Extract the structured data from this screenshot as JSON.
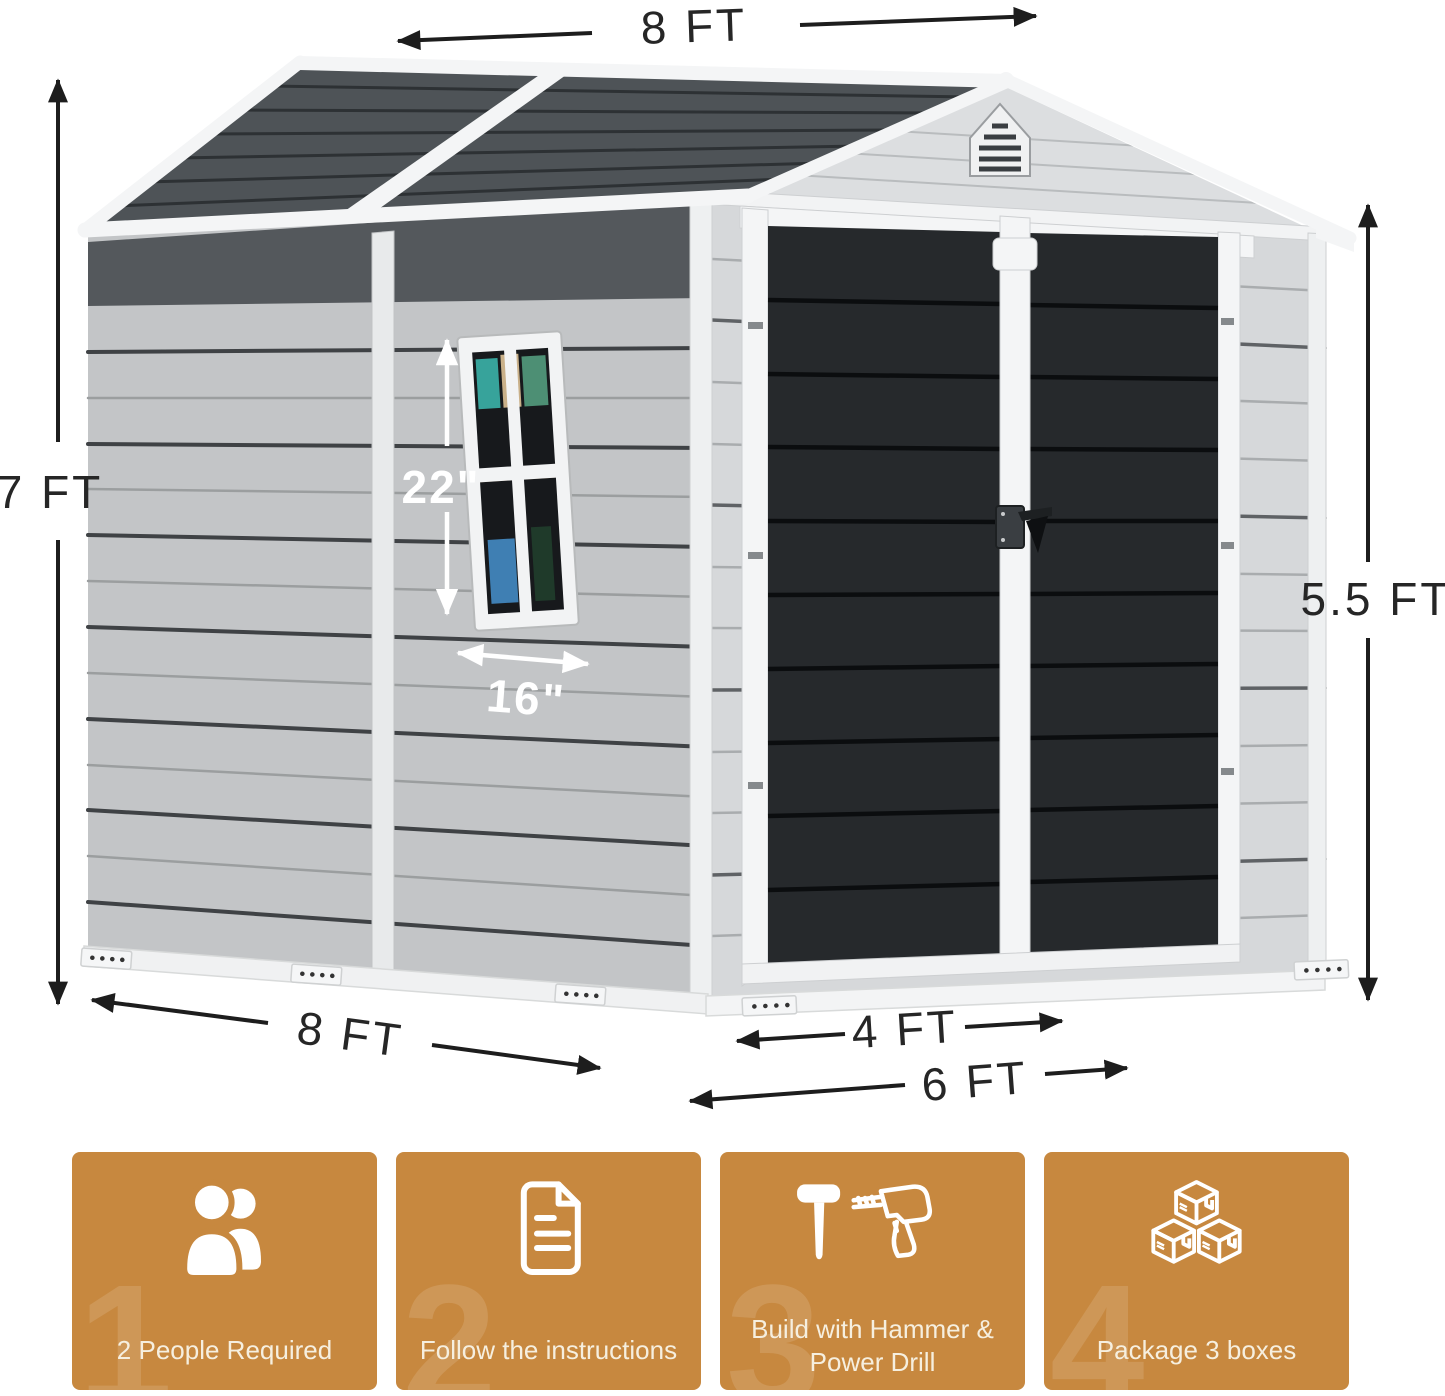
{
  "dims": {
    "roof_length": "8 FT",
    "wall_height": "7 FT",
    "door_height": "5.5 FT",
    "base_depth": "8 FT",
    "door_width": "4 FT",
    "front_width": "6 FT",
    "window_height": "22\"",
    "window_width": "16\""
  },
  "features": [
    {
      "icon": "people-icon",
      "watermark": "1",
      "lines": [
        "2 People Required"
      ]
    },
    {
      "icon": "document-icon",
      "watermark": "2",
      "lines": [
        "Follow the instructions"
      ]
    },
    {
      "icon": "hammer-drill-icon",
      "watermark": "3",
      "lines": [
        "Build with Hammer &",
        "Power Drill"
      ]
    },
    {
      "icon": "boxes-icon",
      "watermark": "4",
      "lines": [
        "Package 3 boxes"
      ]
    }
  ],
  "colors": {
    "accent_orange": "#C7883F",
    "feature_text": "#F6EFDF",
    "roof_dark": "#4E5357",
    "door_dark": "#26292C",
    "siding_side": "#C3C5C7",
    "siding_front": "#D6D8DA",
    "gable": "#DCDEE0",
    "trim_white": "#F4F5F6",
    "dimension_text": "#262626",
    "eave_shadow": "#54585C"
  }
}
